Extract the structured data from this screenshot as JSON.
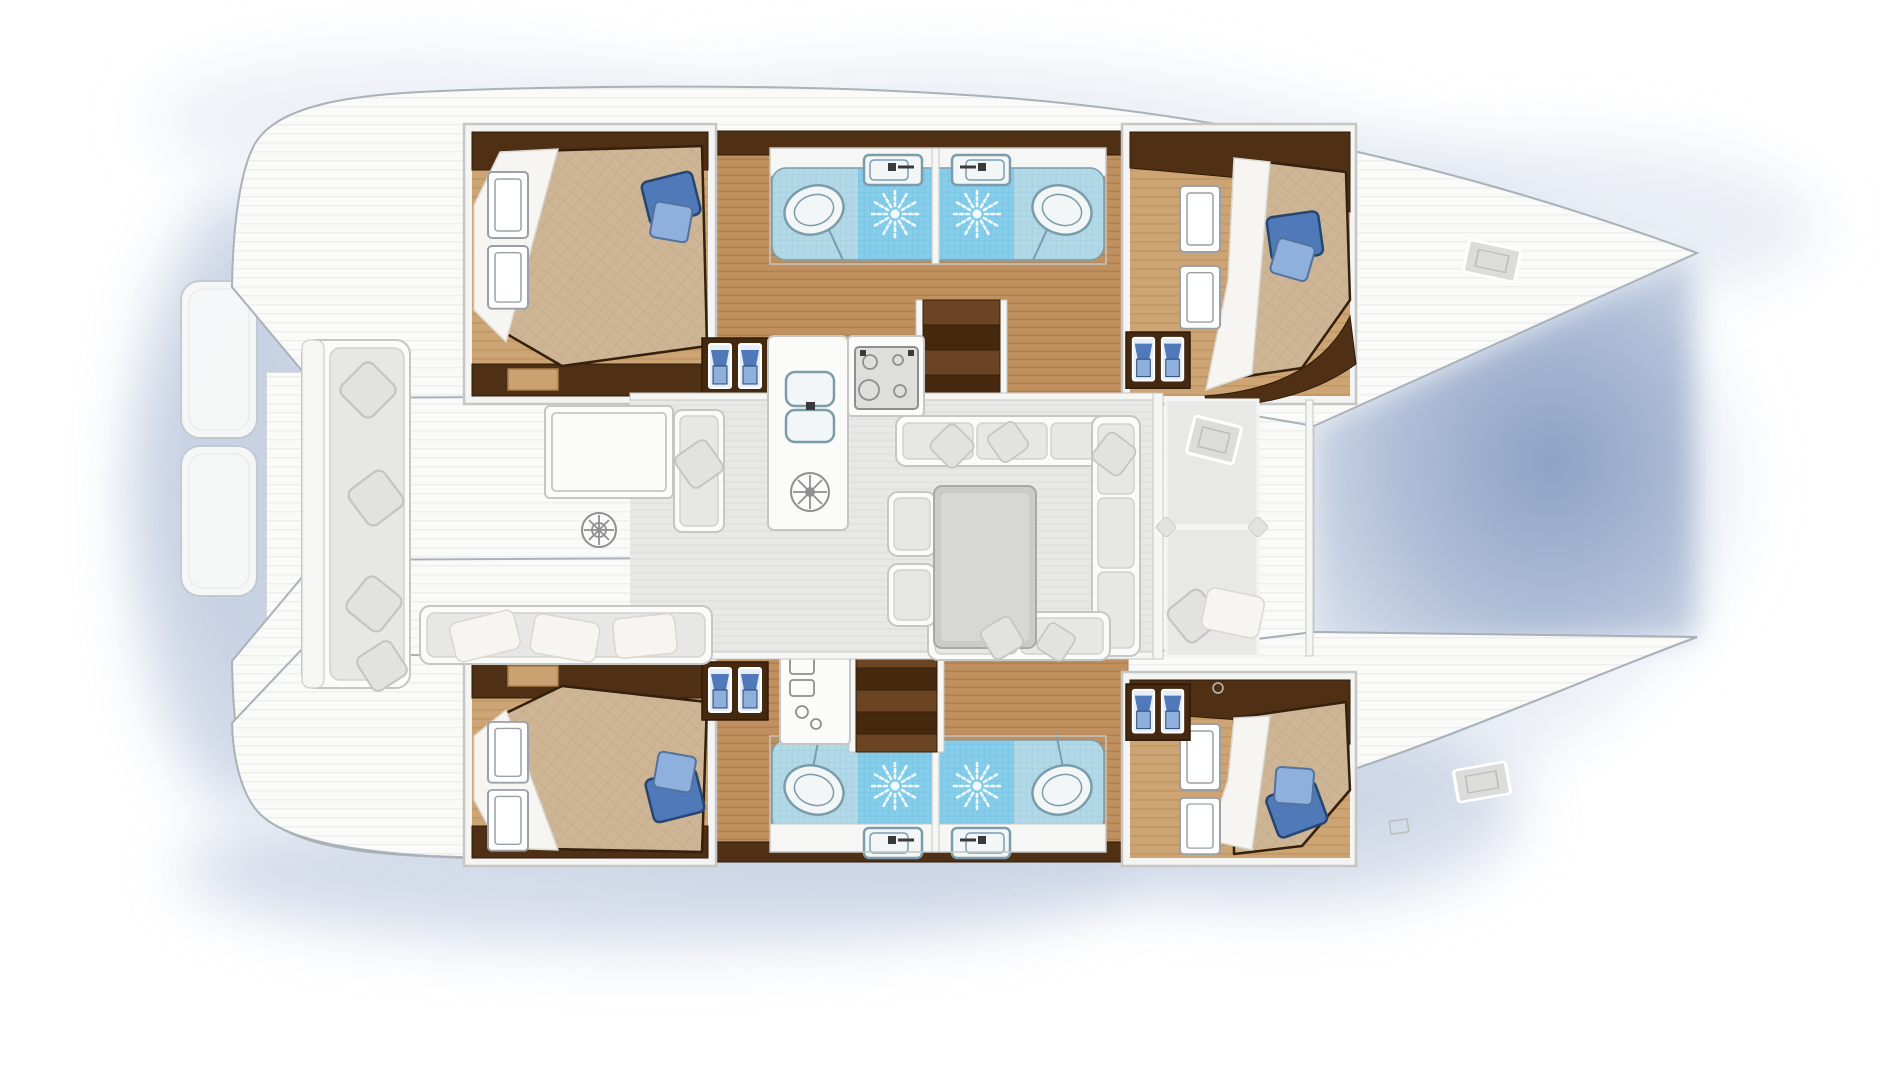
{
  "image_type": "catamaran-yacht-interior-floor-plan",
  "orientation": {
    "bow": "right",
    "stern": "left",
    "port_hull": "top",
    "starboard_hull": "bottom"
  },
  "inventory": {
    "cabins_with_double_beds": 4,
    "bathrooms": 4,
    "showers": 4,
    "toilets": 4,
    "washbasins": 4,
    "companionway_stairs": 2,
    "wardrobe_lockers": 4,
    "galley": {
      "sink_basins": 2,
      "cooktop_burners": 4,
      "round_plate": 1
    },
    "saloon_dining_table": 1,
    "cockpit_round_table": 1,
    "deck_hatches": 4,
    "blue_bed_pillows": 4,
    "stern_platforms": 2
  },
  "palette": {
    "bg": "#ffffff",
    "deck": "#fafaf9",
    "deck-line": "#ebebe9",
    "deck-stroke": "#c9cfd5",
    "hull-stroke": "#a9b1b9",
    "platform-stroke": "#c3c9d1",
    "frame-stroke": "#c6c6c4",
    "cabin-frame": "#f4f4f3",
    "wood": "#c0905e",
    "wood-line": "#aa7c4c",
    "wood-light": "#cda473",
    "darkwood": "#4f3015",
    "darkwood2": "#44280f",
    "darkwood-edge": "#2e1a08",
    "tan-slot": "#caa170",
    "bed": "#cdb595",
    "bed-line": "#bfa683",
    "bed-edge": "#35200d",
    "sheet": "#f6f5f1",
    "sheet-shade": "#d9d7d0",
    "pillow-blue": "#4f79b8",
    "pillow-blue-dark": "#27466f",
    "pillow-blue-mid": "#53739f",
    "pillow-blue-light": "#8fafdc",
    "tile": "#b3d9e8",
    "tile-line": "#9ecadb",
    "tile-bright": "#86cdea",
    "tile-bright-line": "#6fbede",
    "sun": "#f2fbff",
    "fixture": "#f2f6f6",
    "fixture-stroke": "#7b9cab",
    "counter": "#f6f6f4",
    "floor": "#e8e8e6",
    "floor-line": "#dddddb",
    "furn": "#fbfbfa",
    "furn-stroke": "#c6c6c4",
    "cushion": "#e7e7e5",
    "cushion-stroke": "#d1d1cf",
    "pillow-gray": "#e2e2e0",
    "pillow-gray-stroke": "#c5c5c3",
    "table": "#cbcbc9",
    "table-in": "#d7d7d5",
    "table-rim": "#a8a8a6",
    "stair-light": "#6b4423",
    "stair-dark": "#46280e",
    "appliance": "#dededd",
    "appliance-stroke": "#8f8f91",
    "faucet": "#3a3a3a",
    "ward-unit": "#e8eef8",
    "window-stroke": "#9aa0a6",
    "hatch": "#dcdcda",
    "hatch-stroke": "#bdbdbb",
    "shadow-soft": "#dbe2ee",
    "shadow-mid": "#b0bfd8",
    "shadow-deep": "#93a7c8",
    "water-edge": "#d8e0ec",
    "water-deep": "#8ca1c3"
  }
}
